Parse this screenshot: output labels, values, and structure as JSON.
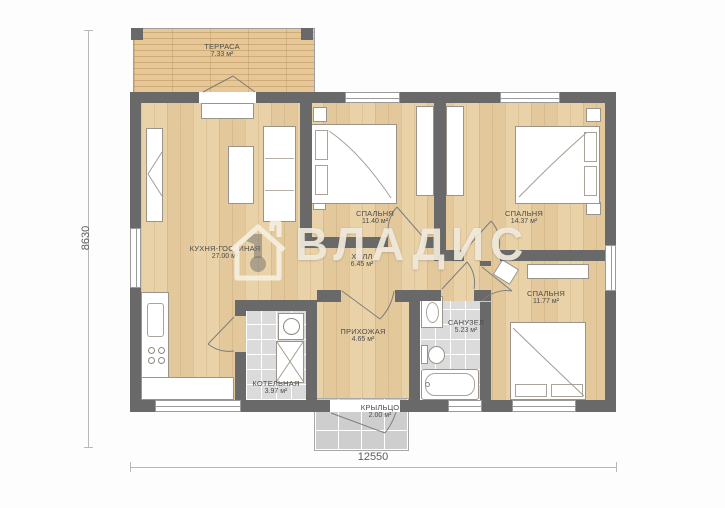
{
  "plan": {
    "watermark_text": "ВЛАДИС",
    "dim_height": "8630",
    "dim_width": "12550"
  },
  "rooms": [
    {
      "name": "ТЕРРАСА",
      "area": "7.33 м²"
    },
    {
      "name": "КУХНЯ-ГОСТИНАЯ",
      "area": "27.00 м²"
    },
    {
      "name": "СПАЛЬНЯ",
      "area": "11.40 м²"
    },
    {
      "name": "СПАЛЬНЯ",
      "area": "14.37 м²"
    },
    {
      "name": "ХОЛЛ",
      "area": "6.45 м²"
    },
    {
      "name": "ПРИХОЖАЯ",
      "area": "4.65 м²"
    },
    {
      "name": "САНУЗЕЛ",
      "area": "5.23 м²"
    },
    {
      "name": "СПАЛЬНЯ",
      "area": "11.77 м²"
    },
    {
      "name": "КОТЕЛЬНАЯ",
      "area": "3.97 м²"
    },
    {
      "name": "КРЫЛЬЦО",
      "area": "2.00 м²"
    }
  ],
  "colors": {
    "wall": "#696969",
    "wood_floor": "#e9cfa3",
    "terrace_wood": "#e6c795",
    "tile_floor": "#dbdbdb",
    "porch_tile": "#cecece",
    "watermark": "#f4ede0",
    "label_text": "#4c4c4c"
  },
  "icons": {
    "watermark_logo": "house-keyhole-icon"
  }
}
